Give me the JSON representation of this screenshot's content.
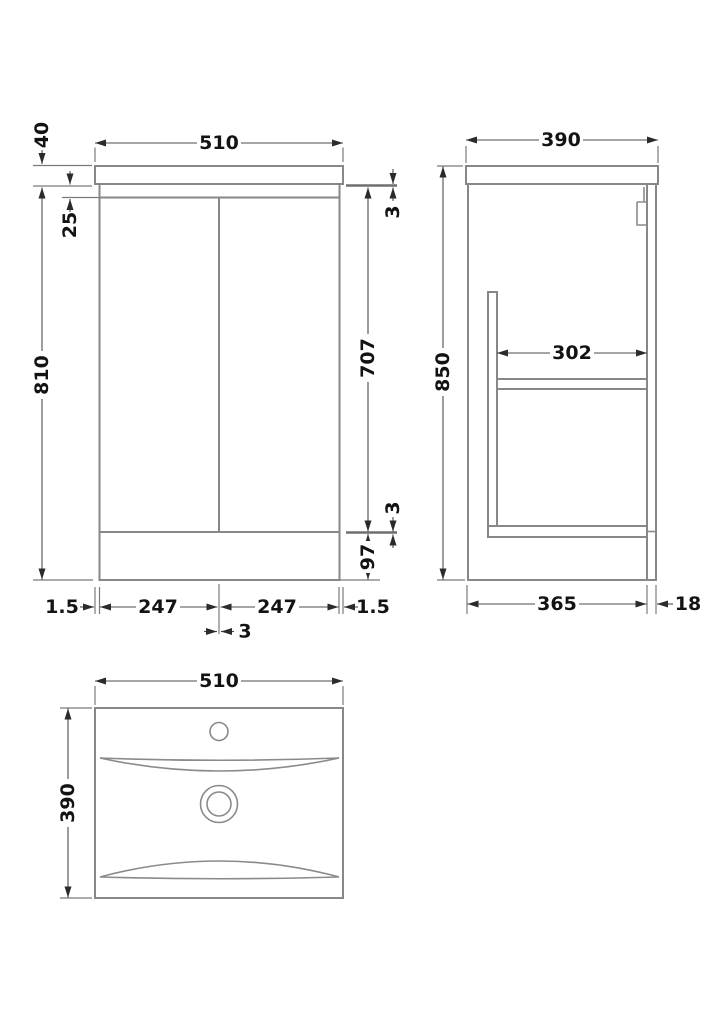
{
  "colors": {
    "background": "#ffffff",
    "object_line": "#878787",
    "dimension_line": "#4d4d4d",
    "arrow": "#2b2b2b",
    "label_text": "#131313"
  },
  "views": {
    "front": {
      "width": "510",
      "worktop_thickness": "40",
      "top_inset": "25",
      "body_height": "810",
      "top_gap": "3",
      "door_height": "707",
      "bottom_gap": "3",
      "plinth_height": "97",
      "left_overhang": "1.5",
      "left_door_width": "247",
      "right_door_width": "247",
      "right_overhang": "1.5",
      "door_gap": "3"
    },
    "side": {
      "depth": "390",
      "total_height": "850",
      "shelf_depth": "302",
      "base_depth": "365",
      "back_panel_thickness": "18"
    },
    "plan": {
      "width": "510",
      "depth": "390"
    }
  }
}
